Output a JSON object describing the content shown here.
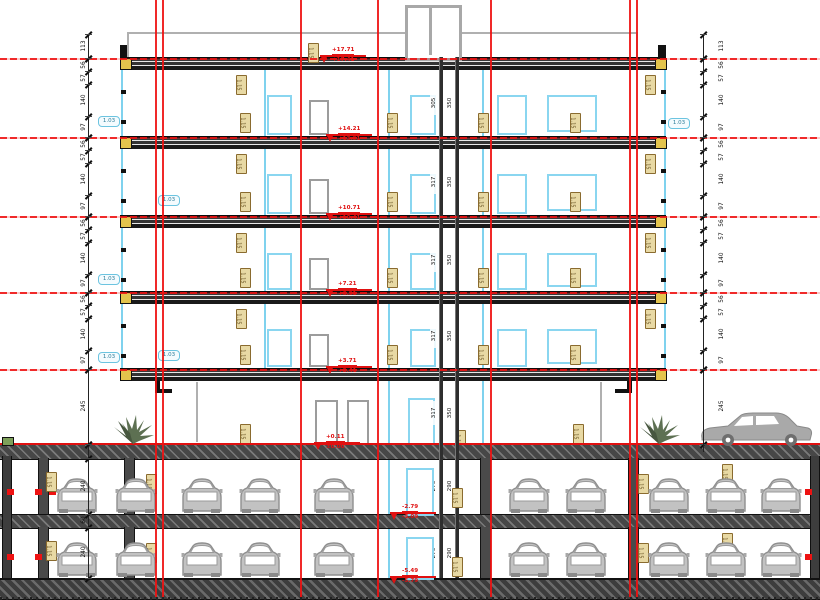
{
  "colors": {
    "grid_red": "#ee1212",
    "frame_cyan": "#8ad6f0",
    "slab_dark": "#2e2e2e",
    "tag_tan": "#e8d9a4",
    "car_gray": "#b5b5b5",
    "marker_red": "#e01010",
    "end_block_yellow": "#e3c44d"
  },
  "levels": [
    {
      "name": "roof",
      "marker_upper": "+17.71",
      "marker_lower": "+17.41",
      "core_dim_a": "305",
      "core_dim_b": "350"
    },
    {
      "name": "floor-5",
      "marker_upper": "+14.21",
      "marker_lower": "+13.91",
      "core_dim_a": "317",
      "core_dim_b": "350"
    },
    {
      "name": "floor-4",
      "marker_upper": "+10.71",
      "marker_lower": "+10.41",
      "core_dim_a": "317",
      "core_dim_b": "350"
    },
    {
      "name": "floor-3",
      "marker_upper": "+7.21",
      "marker_lower": "+6.91",
      "core_dim_a": "317",
      "core_dim_b": "350"
    },
    {
      "name": "floor-2",
      "marker_upper": "+3.71",
      "marker_lower": "+3.41",
      "core_dim_a": "317",
      "core_dim_b": "350"
    },
    {
      "name": "floor-1",
      "marker_upper": "+0.11",
      "marker_lower": "±0.00",
      "core_dim_a": "317",
      "core_dim_b": "350"
    },
    {
      "name": "basement-1",
      "marker_upper": "-2.79",
      "marker_lower": "-3.09",
      "core_dim_a": "270",
      "core_dim_b": "290"
    },
    {
      "name": "basement-2",
      "marker_upper": "-5.49",
      "marker_lower": "-5.79",
      "core_dim_a": "270",
      "core_dim_b": "290"
    }
  ],
  "dimensions": {
    "parapet": "113",
    "floor_pattern": [
      "56",
      "57",
      "140",
      "97"
    ],
    "ground_floor": "245",
    "parking_level": "240",
    "slab": "60"
  },
  "tags": {
    "wall_tag": "1.15",
    "window_tag": "1.03"
  }
}
